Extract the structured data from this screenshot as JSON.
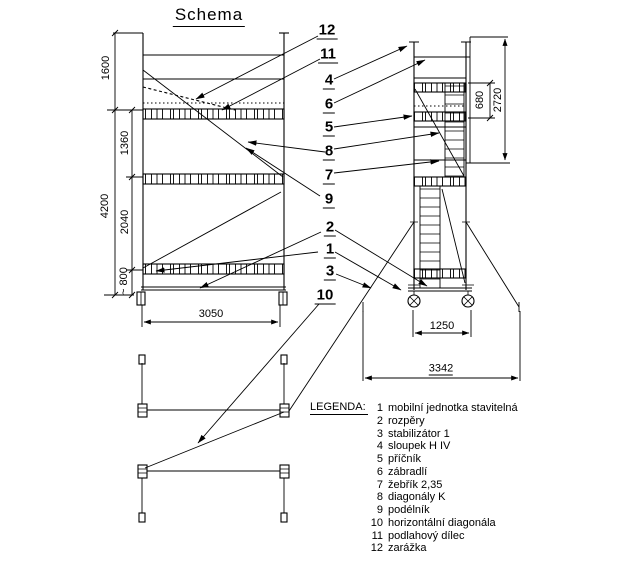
{
  "title": "Schema",
  "colors": {
    "line": "#000000",
    "background": "#ffffff"
  },
  "callouts": [
    "12",
    "11",
    "4",
    "6",
    "5",
    "8",
    "7",
    "9",
    "2",
    "1",
    "3",
    "10"
  ],
  "dimensions": {
    "front_view": {
      "guardrail_height": "1600",
      "upper_bay": "1360",
      "lower_bay": "2040",
      "base_height": "~ 800",
      "total_height": "4200",
      "platform_length": "3050"
    },
    "side_view": {
      "platform_offset": "680",
      "upper_height": "2720",
      "frame_width": "1250",
      "stabilizer_span": "3342"
    }
  },
  "legend": {
    "header": "LEGENDA:",
    "items": [
      {
        "number": "1",
        "label": "mobilní jednotka stavitelná"
      },
      {
        "number": "2",
        "label": "rozpěry"
      },
      {
        "number": "3",
        "label": "stabilizátor 1"
      },
      {
        "number": "4",
        "label": "sloupek H IV"
      },
      {
        "number": "5",
        "label": "příčník"
      },
      {
        "number": "6",
        "label": "zábradlí"
      },
      {
        "number": "7",
        "label": "žebřík 2,35"
      },
      {
        "number": "8",
        "label": "diagonály K"
      },
      {
        "number": "9",
        "label": "podélník"
      },
      {
        "number": "10",
        "label": "horizontální diagonála"
      },
      {
        "number": "11",
        "label": "podlahový dílec"
      },
      {
        "number": "12",
        "label": "zarážka"
      }
    ]
  }
}
